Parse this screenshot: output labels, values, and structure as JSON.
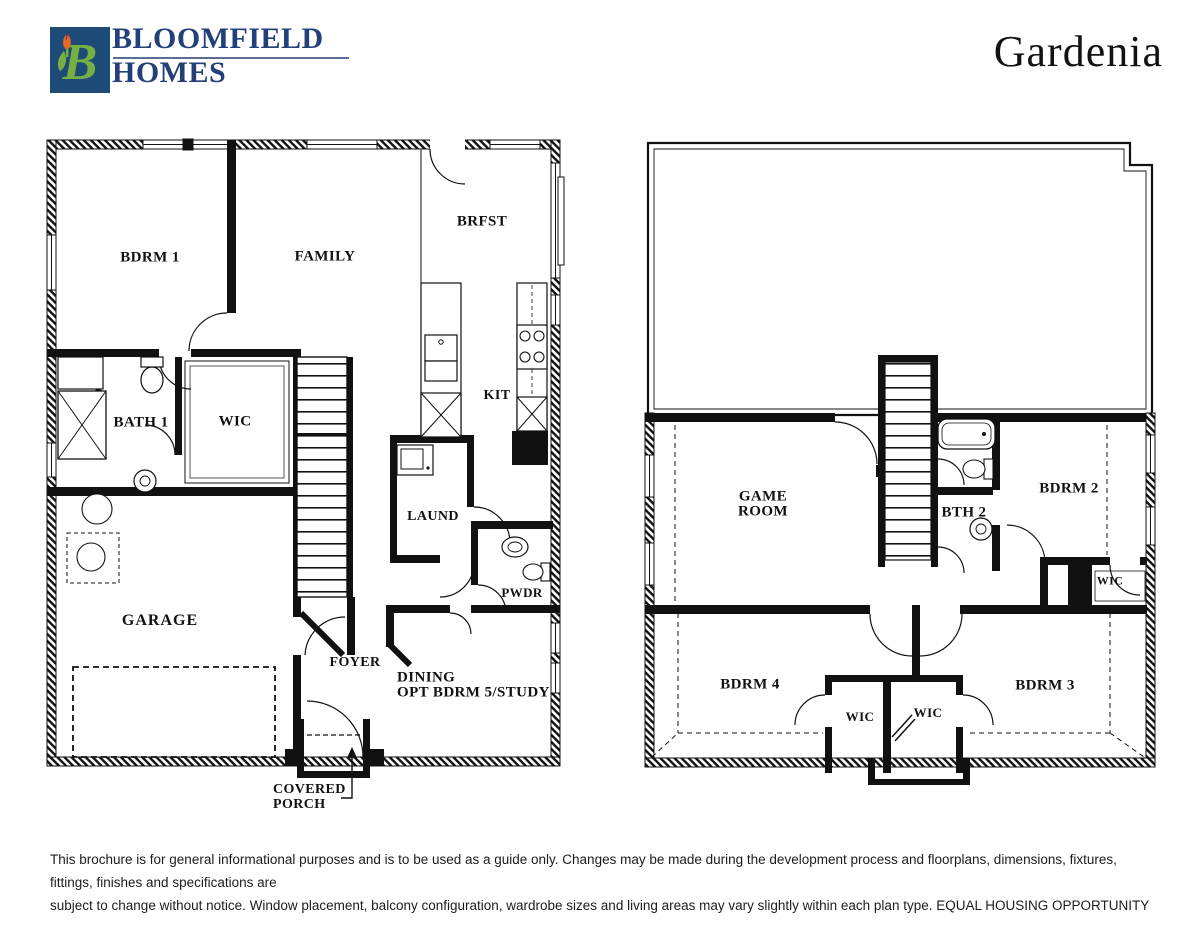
{
  "header": {
    "brand_name_line1": "BLOOMFIELD",
    "brand_name_line2": "HOMES",
    "plan_name": "Gardenia",
    "logo_colors": {
      "square": "#1E4B77",
      "letter_b": "#76B043",
      "tulip_petals": "#E96A24",
      "tulip_tip": "#C43B2A",
      "wordmark": "#24407A"
    }
  },
  "first_floor_plan": {
    "rooms": {
      "bdrm1": "BDRM 1",
      "family": "FAMILY",
      "brfst": "BRFST",
      "kit": "KIT",
      "bath1": "BATH 1",
      "wic": "WIC",
      "laund": "LAUND",
      "pwdr": "PWDR",
      "garage": "GARAGE",
      "foyer": "FOYER",
      "dining_line1": "DINING",
      "dining_line2": "OPT BDRM 5/STUDY",
      "porch_line1": "COVERED",
      "porch_line2": "PORCH"
    }
  },
  "second_floor_plan": {
    "rooms": {
      "game_room_line1": "GAME",
      "game_room_line2": "ROOM",
      "bth2": "BTH 2",
      "bdrm2": "BDRM 2",
      "wic_bdrm2": "WIC",
      "bdrm4": "BDRM 4",
      "wic_bdrm4": "WIC",
      "wic_bdrm3": "WIC",
      "bdrm3": "BDRM 3"
    }
  },
  "footer": {
    "disclaimer_line1": "This brochure is for general informational purposes and is to be used as a guide only. Changes may be made during the development process and floorplans, dimensions, fixtures, fittings, finishes and specifications are",
    "disclaimer_line2": "subject to change without notice. Window placement, balcony configuration, wardrobe sizes and living areas may vary slightly within each plan type.  EQUAL HOUSING OPPORTUNITY"
  }
}
